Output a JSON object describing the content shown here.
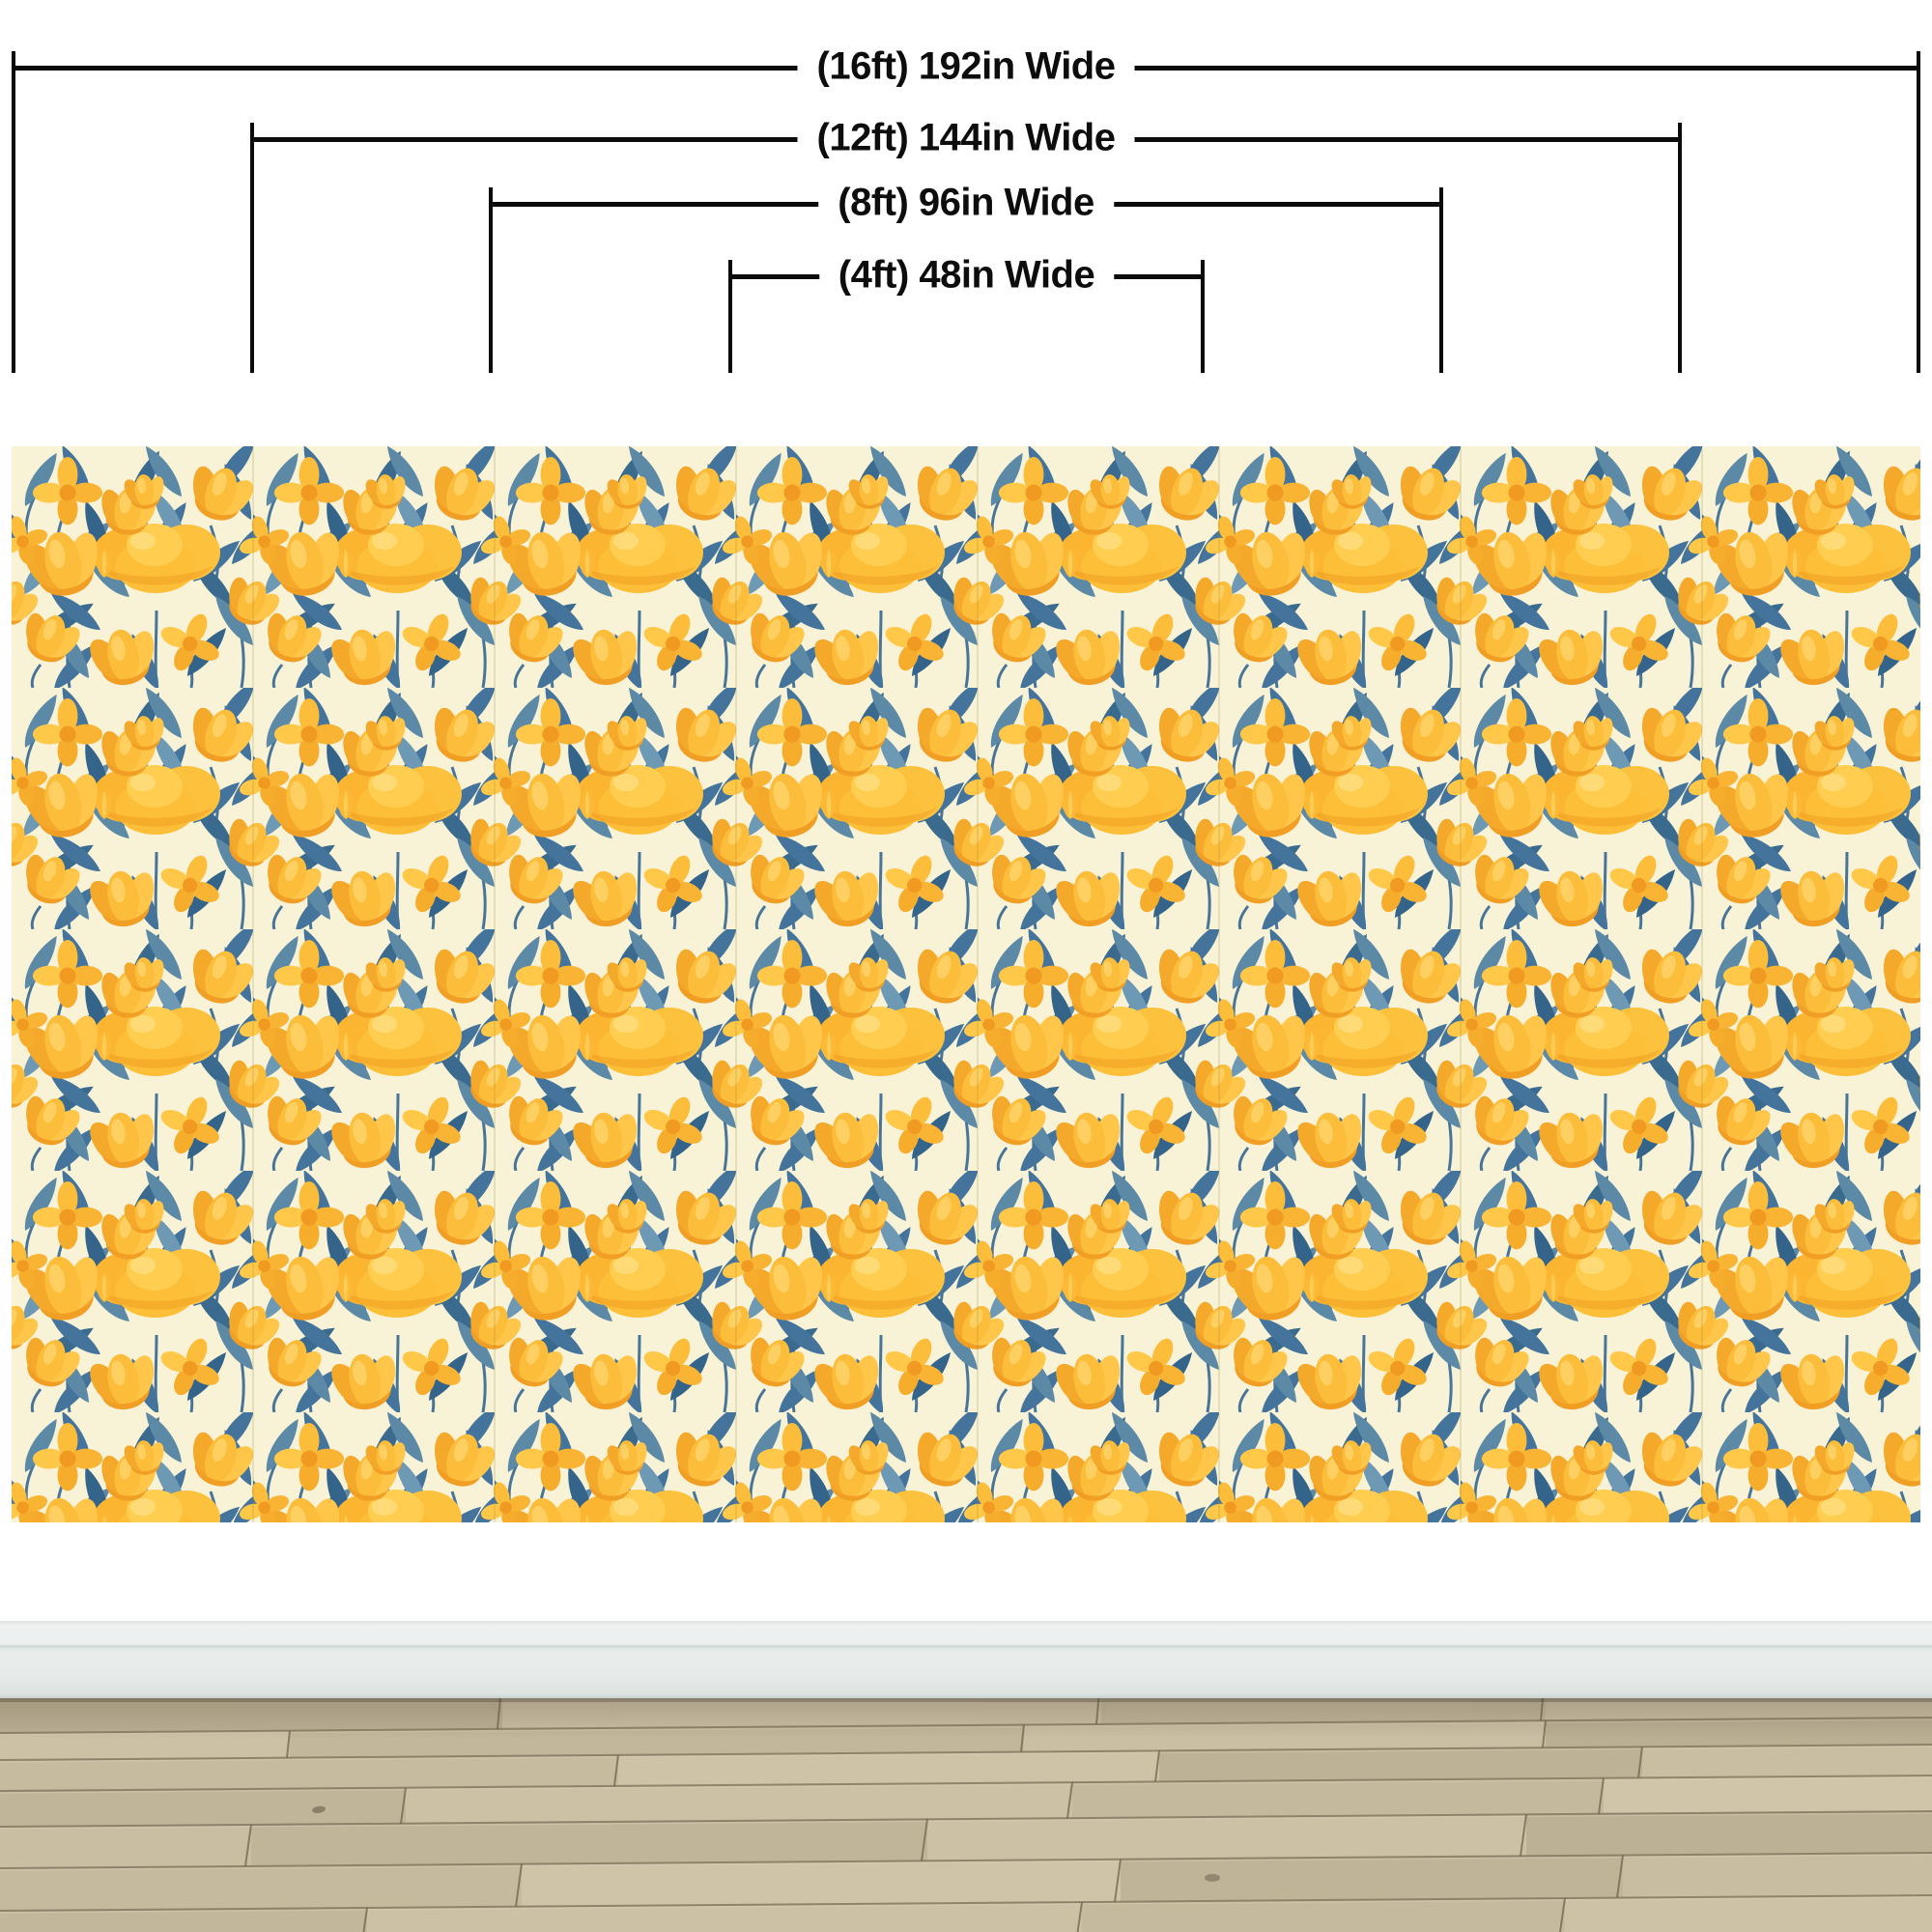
{
  "size_guide": {
    "brackets": [
      {
        "label": "(16ft) 192in Wide",
        "feet": 16,
        "inches": 192
      },
      {
        "label": "(12ft) 144in Wide",
        "feet": 12,
        "inches": 144
      },
      {
        "label": "(8ft) 96in Wide",
        "feet": 8,
        "inches": 96
      },
      {
        "label": "(4ft) 48in Wide",
        "feet": 4,
        "inches": 48
      }
    ]
  },
  "palette": {
    "diagram_line": "#0b0b0b",
    "wall_white": "#ffffff",
    "wallpaper_background_cream": "#f8f2d7",
    "wallpaper_flower_yellow": "#fcbd3a",
    "wallpaper_flower_deep": "#f09c22",
    "wallpaper_flower_light": "#ffd76f",
    "wallpaper_leaf_blue": "#44749b",
    "wallpaper_leaf_dark": "#35648a",
    "wallpaper_leaf_light": "#6e99b4",
    "wallpaper_seam": "#9b8434",
    "baseboard_gray": "#e7eceb",
    "floor_wood_tan": "#c3b79c",
    "floor_seam_brown": "#857a61"
  }
}
